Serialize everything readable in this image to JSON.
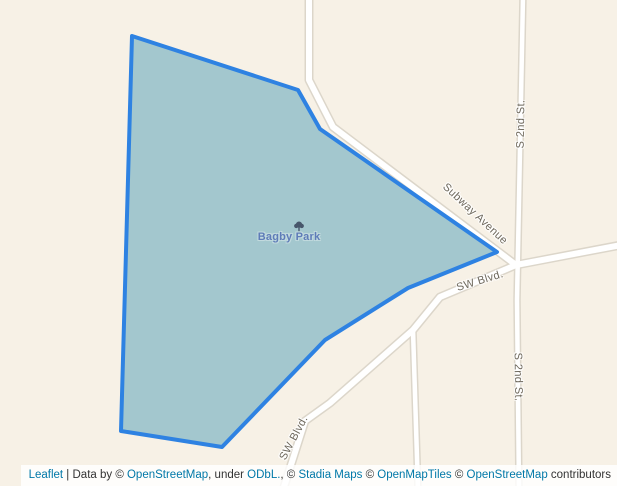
{
  "map": {
    "background_color": "#f7f1e6",
    "road_color": "#ffffff",
    "road_casing_color": "#dcd6ca",
    "road_label_color": "#6e685c",
    "park": {
      "label": "Bagby Park",
      "fill_color": "#a3c7ce",
      "border_color": "#2e82e2",
      "label_color": "#5e7cb8",
      "icon": "tree-icon",
      "icon_color": "#47566b"
    },
    "road_labels": [
      {
        "text": "Subway Avenue"
      },
      {
        "text": "S 2nd St."
      },
      {
        "text": "S 2nd St."
      },
      {
        "text": "SW Blvd."
      },
      {
        "text": "SW Blvd."
      }
    ]
  },
  "attribution": {
    "link_color": "#0078A8",
    "parts": [
      {
        "text": "Leaflet",
        "link": true
      },
      {
        "text": " | Data by © ",
        "link": false
      },
      {
        "text": "OpenStreetMap",
        "link": true
      },
      {
        "text": ", under ",
        "link": false
      },
      {
        "text": "ODbL.",
        "link": true
      },
      {
        "text": ", © ",
        "link": false
      },
      {
        "text": "Stadia Maps",
        "link": true
      },
      {
        "text": " © ",
        "link": false
      },
      {
        "text": "OpenMapTiles",
        "link": true
      },
      {
        "text": " © ",
        "link": false
      },
      {
        "text": "OpenStreetMap",
        "link": true
      },
      {
        "text": " contributors",
        "link": false
      }
    ]
  }
}
